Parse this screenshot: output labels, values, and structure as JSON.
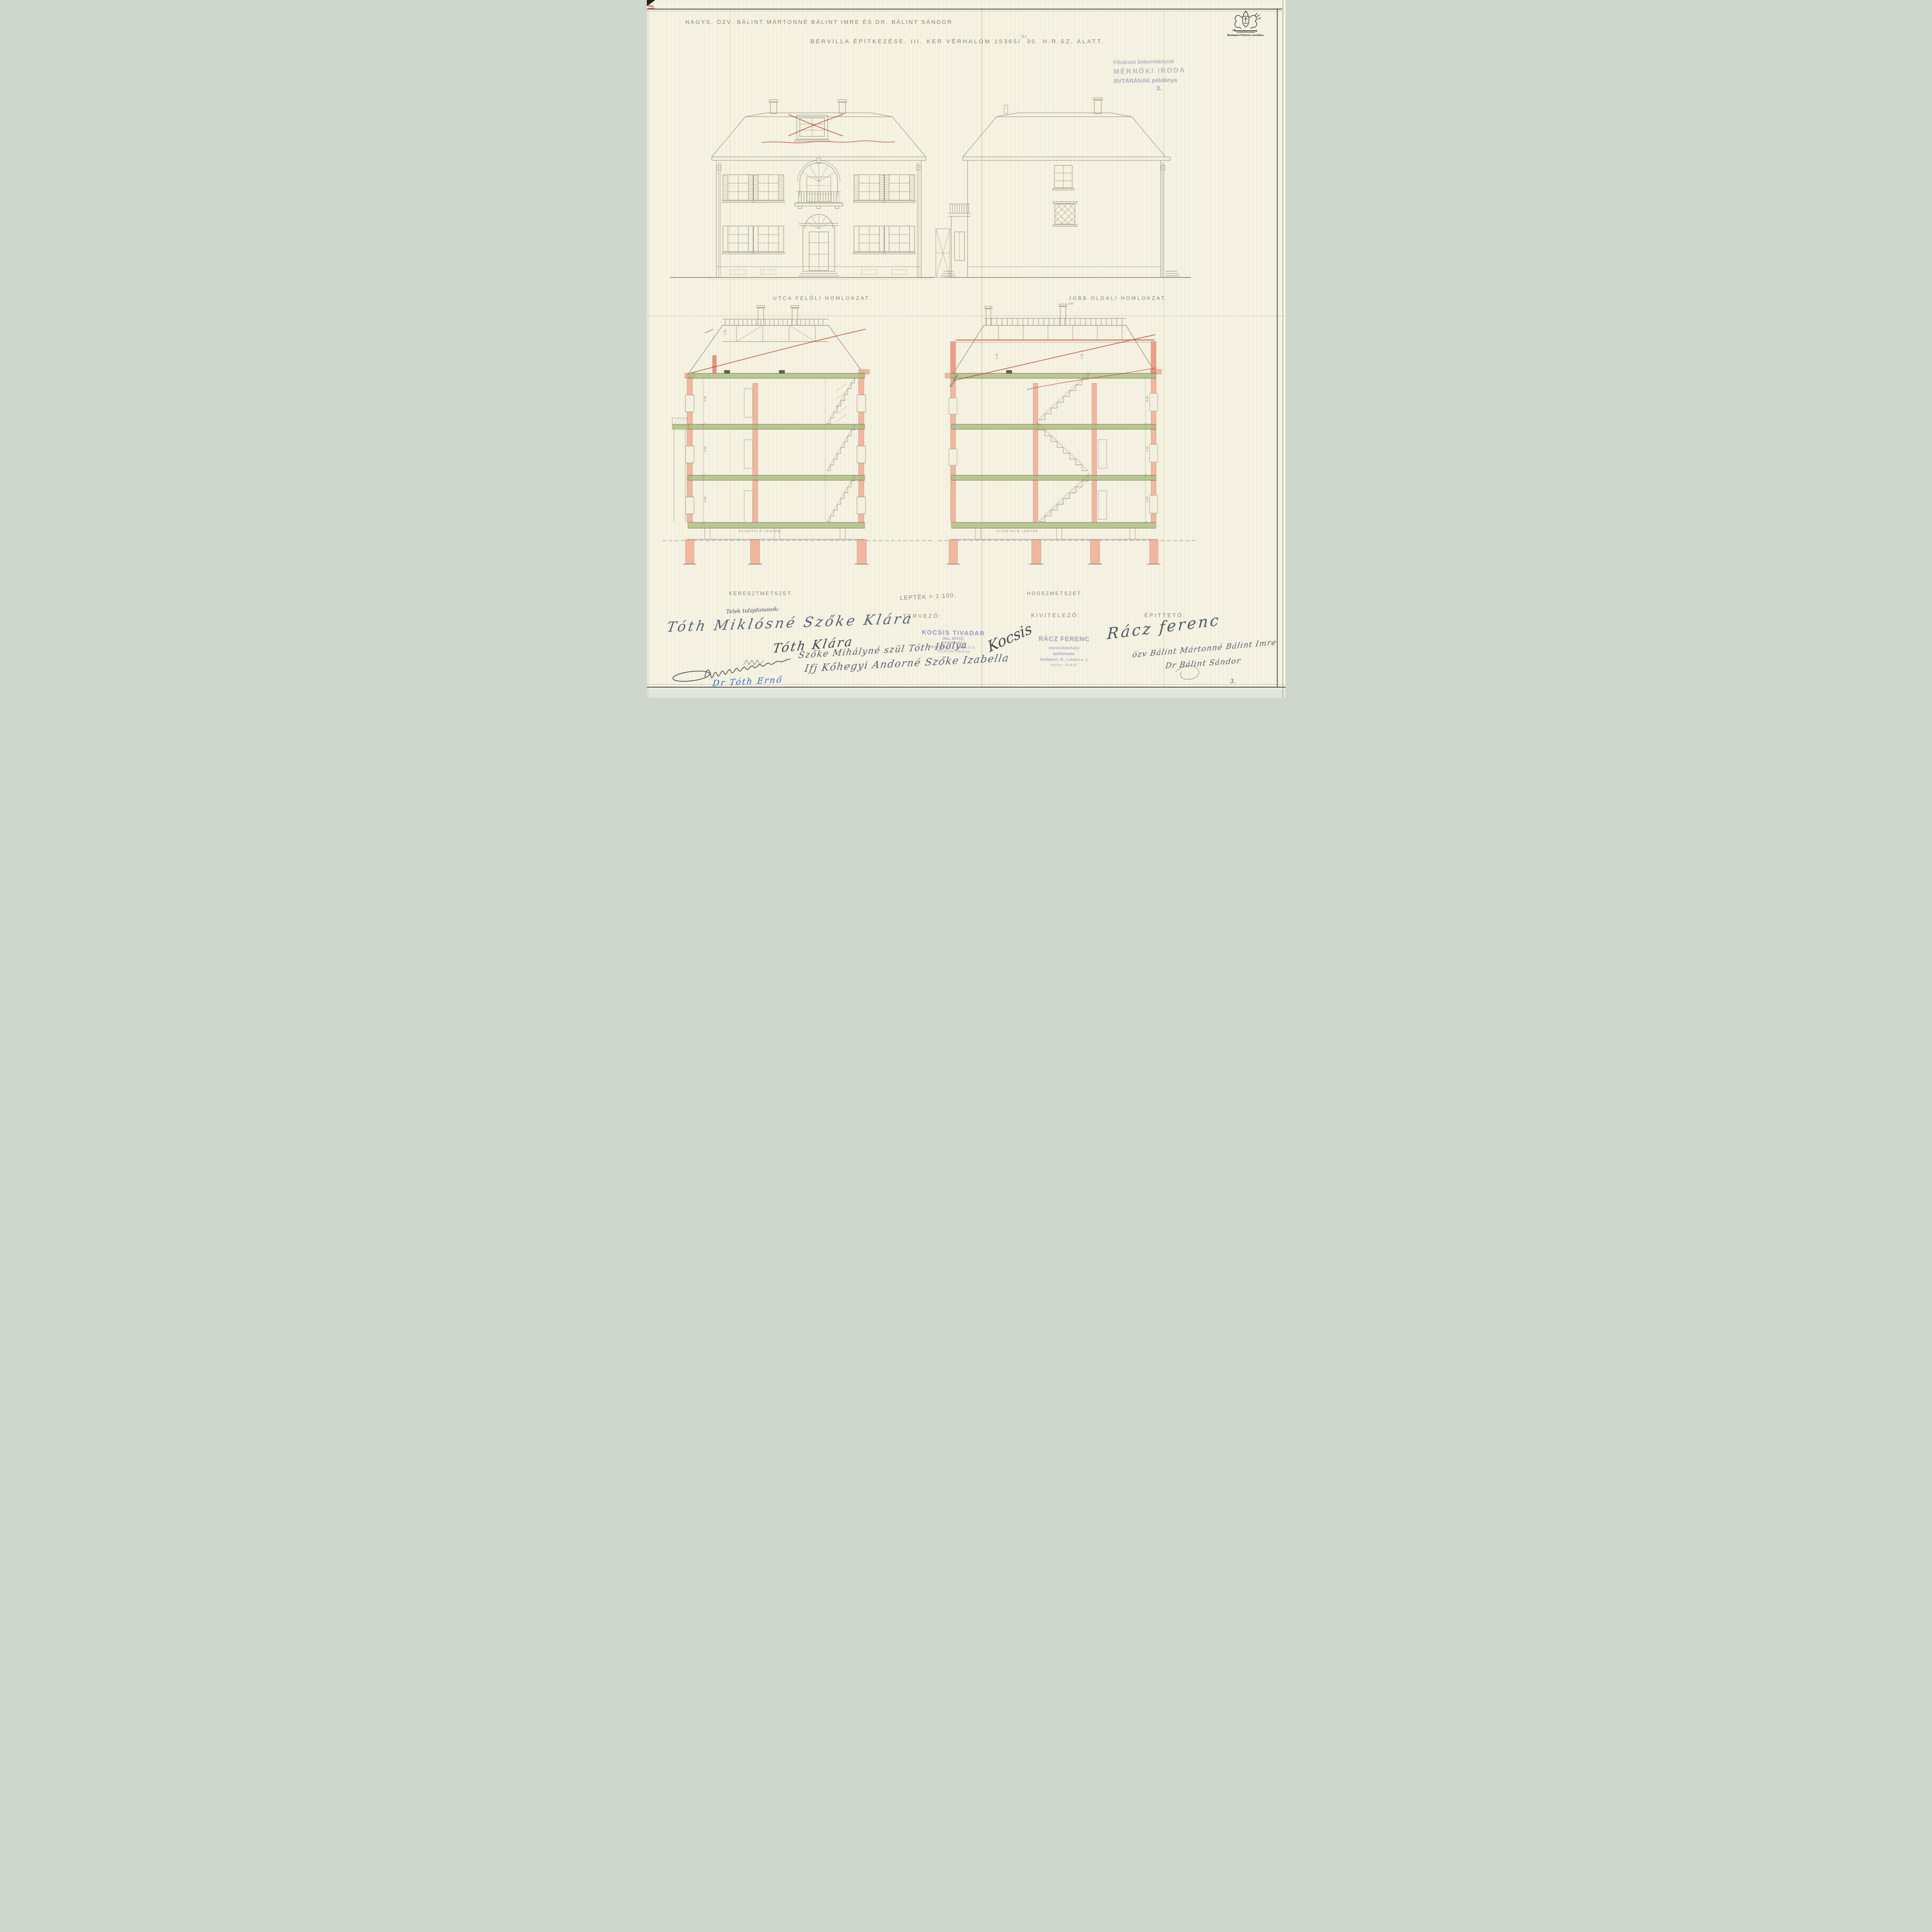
{
  "sheet": {
    "archive": {
      "logo_caption": "Budapest Főváros Levéltára"
    },
    "title": {
      "line1": "NAGYS. ÖZV. BÁLINT MÁRTONNÉ BÁLINT IMRE ÉS DR. BÁLINT SÁNDOR",
      "line2_before": "BÉRVILLA ÉPÍTKEZÉSE. III. KER VÉRHALOM 15365/",
      "line2_inserted": "ÚJ",
      "line2_after": "30. H.R.SZ. ALATT."
    },
    "archive_stamp": {
      "line1": "Fővárosi önkormányzat",
      "line2": "MÉRNÖKI IRODA",
      "line3": "RVTÁRÁNAK példánya",
      "copy_no": "3."
    },
    "page_no": "3."
  },
  "drawings": {
    "scale_note": "LÉPTÉK = 1:100.",
    "front_elevation": {
      "label": "UTCA FELŐLI HOMLOKZAT."
    },
    "side_elevation": {
      "label": "JOBB OLDALI HOMLOKZAT."
    },
    "cross_section": {
      "label": "KERESZTMETSZET.",
      "air_gap": "SZIGETELŐ LÉGTÉR",
      "dims": [
        "1.50",
        "3.10",
        "3.10",
        "2.20"
      ]
    },
    "long_section": {
      "label": "HOSSZMETSZET.",
      "air_gap": "SZIGETELŐ LÉGTÉR",
      "note": "Műszaki",
      "dims": [
        "3.00",
        "2.70",
        "2.70",
        "3.10",
        "3.10",
        "2.20"
      ]
    }
  },
  "parties": {
    "owners_heading": "Telek tulajdonosok:",
    "owner_signatures": [
      "Tóth Miklósné Szőke Klára",
      "Tóth Klára",
      "Szőke Mihályné szül Tóth Ibolya",
      "Ifj Kőhegyi Andorné Szőke Izabella",
      "Dr Tóth Ernő"
    ],
    "designer": {
      "label": "TERVEZŐ:",
      "stamp_name": "KOCSIS TIVADAR",
      "stamp_lines": [
        "OKL. ÉPÍTŐ,",
        "IPARMŰVÉSZ",
        "BUDAPEST, II. BARS-U. 5.",
        "TELEFON : 50-8-14"
      ],
      "signature": "Kocsis"
    },
    "contractor": {
      "label": "KIVITELEZŐ:",
      "stamp_name": "RÁCZ FERENC",
      "stamp_lines": [
        "marosvásárhelyi",
        "építőmester",
        "Budapest, III., Lukács-u. 2",
        "telefon : 50-8-87"
      ],
      "signature": "Rácz ferenc"
    },
    "client": {
      "label": "ÉPITTETŐ:",
      "signatures": [
        "özv Bálint Mártonné Bálint Imre",
        "Dr Bálint Sándor"
      ]
    }
  }
}
